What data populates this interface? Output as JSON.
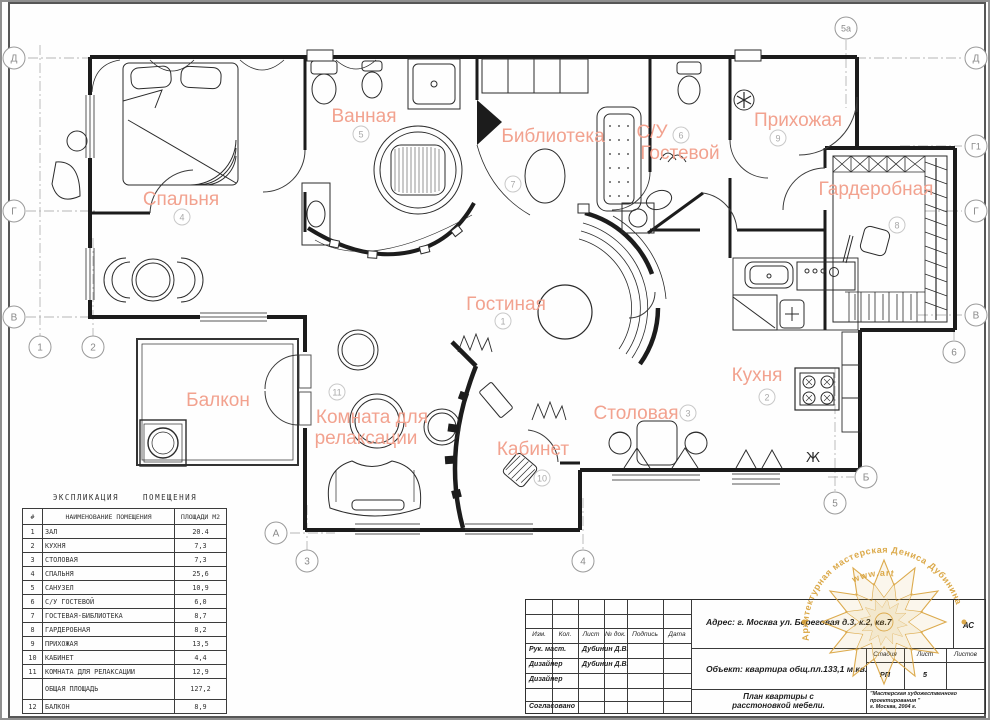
{
  "rooms": [
    {
      "label": "Спальня",
      "num": "4"
    },
    {
      "label": "Ванная",
      "num": "5"
    },
    {
      "label": "Библиотека",
      "num": "7"
    },
    {
      "label": "С/У",
      "label2": "Гостевой",
      "num": "6"
    },
    {
      "label": "Прихожая",
      "num": "9"
    },
    {
      "label": "Гардеробная",
      "num": "8"
    },
    {
      "label": "Гостиная",
      "num": "1"
    },
    {
      "label": "Кухня",
      "num": "2"
    },
    {
      "label": "Столовая",
      "num": "3"
    },
    {
      "label": "Балкон",
      "num": ""
    },
    {
      "label": "Комната для",
      "label2": "релаксации",
      "num": "11"
    },
    {
      "label": "Кабинет",
      "num": "10"
    }
  ],
  "axes": [
    {
      "label": "Д"
    },
    {
      "label": "Г"
    },
    {
      "label": "В"
    },
    {
      "label": "1"
    },
    {
      "label": "2"
    },
    {
      "label": "5а"
    },
    {
      "label": "Д"
    },
    {
      "label": "Г1"
    },
    {
      "label": "Г"
    },
    {
      "label": "В"
    },
    {
      "label": "6"
    },
    {
      "label": "А"
    },
    {
      "label": "3"
    },
    {
      "label": "4"
    },
    {
      "label": "5"
    },
    {
      "label": "Б"
    }
  ],
  "icons": {
    "vent_glyph": "Ж"
  },
  "explication": {
    "title": "ЭКСПЛИКАЦИЯ    ПОМЕЩЕНИЯ",
    "col_num": "#",
    "col_name": "НАИМЕНОВАНИЕ  ПОМЕЩЕНИЯ",
    "col_area": "ПЛОЩАДИ М2",
    "rows": [
      [
        "1",
        "ЗАЛ",
        "20.4"
      ],
      [
        "2",
        "КУХНЯ",
        "7,3"
      ],
      [
        "3",
        "СТОЛОВАЯ",
        "7,3"
      ],
      [
        "4",
        "СПАЛЬНЯ",
        "25,6"
      ],
      [
        "5",
        "САНУЗЕЛ",
        "10,9"
      ],
      [
        "6",
        "С/У ГОСТЕВОЙ",
        "6,0"
      ],
      [
        "7",
        "ГОСТЕВАЯ-БИБЛИОТЕКА",
        "8,7"
      ],
      [
        "8",
        "ГАРДЕРОБНАЯ",
        "8,2"
      ],
      [
        "9",
        "ПРИХОЖАЯ",
        "13,5"
      ],
      [
        "10",
        "КАБИНЕТ",
        "4,4"
      ],
      [
        "11",
        "КОМНАТА ДЛЯ РЕЛАКСАЦИИ",
        "12,9"
      ],
      [
        "",
        "ОБЩАЯ ПЛОЩАДЬ",
        "127,2"
      ],
      [
        "12",
        "БАЛКОН",
        "8,9"
      ]
    ]
  },
  "title_block": {
    "col_izm": "Изм.",
    "col_kol": "Кол.",
    "col_list": "Лист",
    "col_ndok": "№ док.",
    "col_podpis": "Подпись",
    "col_data": "Дата",
    "row1_role": "Рук. маст.",
    "row1_name": "Дубинин Д.В.",
    "row2_role": "Дизайнер",
    "row2_name": "Дубинин Д.В.",
    "row3_role": "Дизайнер",
    "agreed": "Согласовано",
    "address": "Адрес: г. Москва ул. Береговая д.3, к.2, кв.7",
    "code": "АС",
    "object": "Объект: квартира общ.пл.133,1 м.кв.",
    "stage_label": "Стадия",
    "list_label": "Лист",
    "listov_label": "Листов",
    "stage": "РП",
    "list_num": "5",
    "doc_title_line1": "План квартиры с",
    "doc_title_line2": "расстоновкой мебели.",
    "studio": "\"Мастерская художественного проектирования \"",
    "year": "г. Москва, 2004 г."
  },
  "logo": {
    "arc_top": "Архитектурная мастерская Дениса Дубинина",
    "arc_bottom": "www.art",
    "gold": "#d9a23a"
  },
  "colors": {
    "room_label": "#f2a28f",
    "line": "#1c1c1c",
    "axis": "#9a9a9a"
  }
}
